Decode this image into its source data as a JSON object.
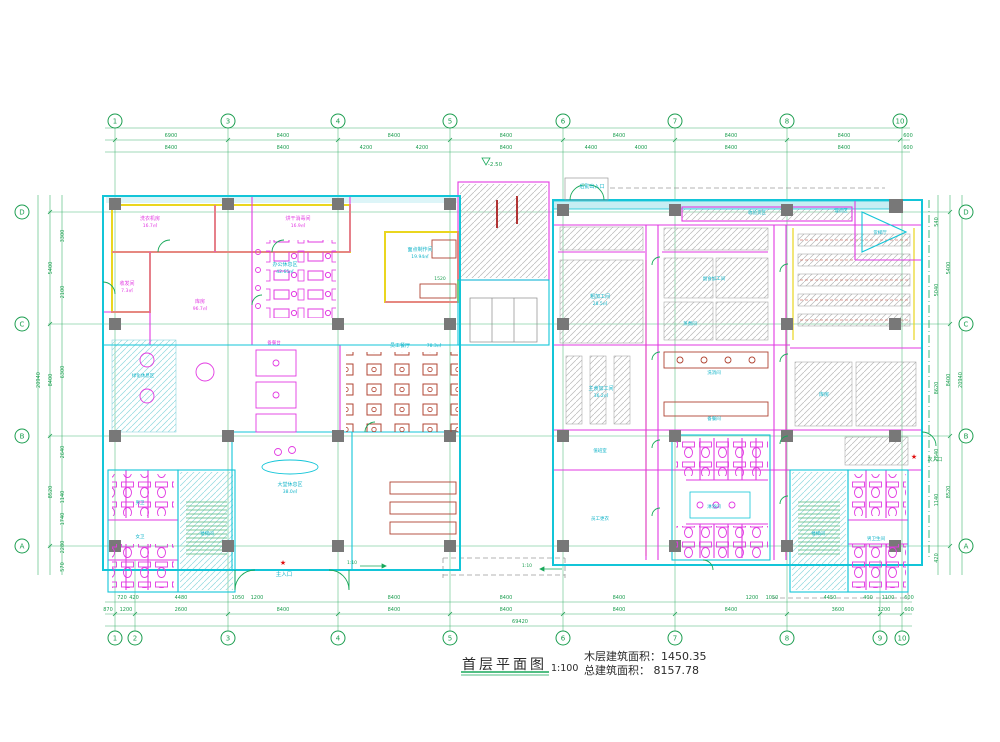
{
  "title_block": {
    "title": "首层平面图",
    "scale": "1:100",
    "area_line1": "木层建筑面积：1450.35",
    "area_line2": "总建筑面积： 8157.78"
  },
  "colors": {
    "grid_green": "#1c9e50",
    "wall_cyan": "#13c5d8",
    "wall_magenta": "#e23ae2",
    "wall_yellow": "#ead61f",
    "furniture_red": "#b04433",
    "entrance_red": "#e01010",
    "label_cyan": "#0fb3c8",
    "title_black": "#2a2a2a"
  },
  "grid": {
    "top_bubbles": [
      {
        "label": "1",
        "x": 115
      },
      {
        "label": "3",
        "x": 228
      },
      {
        "label": "4",
        "x": 338
      },
      {
        "label": "5",
        "x": 450
      },
      {
        "label": "6",
        "x": 563
      },
      {
        "label": "7",
        "x": 675
      },
      {
        "label": "8",
        "x": 787
      },
      {
        "label": "10",
        "x": 900
      }
    ],
    "bottom_bubbles": [
      {
        "label": "1",
        "x": 115
      },
      {
        "label": "2",
        "x": 135
      },
      {
        "label": "3",
        "x": 228
      },
      {
        "label": "4",
        "x": 338
      },
      {
        "label": "5",
        "x": 450
      },
      {
        "label": "6",
        "x": 563
      },
      {
        "label": "7",
        "x": 675
      },
      {
        "label": "8",
        "x": 787
      },
      {
        "label": "9",
        "x": 880
      },
      {
        "label": "10",
        "x": 902
      }
    ],
    "left_bubbles": [
      {
        "label": "D",
        "y": 212
      },
      {
        "label": "C",
        "y": 324
      },
      {
        "label": "B",
        "y": 436
      },
      {
        "label": "A",
        "y": 546
      }
    ],
    "right_bubbles": [
      {
        "label": "D",
        "y": 212
      },
      {
        "label": "C",
        "y": 324
      },
      {
        "label": "B",
        "y": 436
      },
      {
        "label": "A",
        "y": 546
      }
    ]
  },
  "dimensions": {
    "top_row1": [
      [
        "6900",
        171
      ],
      [
        "8400",
        283
      ],
      [
        "8400",
        394
      ],
      [
        "8400",
        506
      ],
      [
        "8400",
        619
      ],
      [
        "8400",
        731
      ],
      [
        "8400",
        844
      ],
      [
        "600",
        908
      ]
    ],
    "top_row2": [
      [
        "8400",
        171
      ],
      [
        "8400",
        283
      ],
      [
        "4200",
        366
      ],
      [
        "4200",
        422
      ],
      [
        "8400",
        506
      ],
      [
        "4400",
        591
      ],
      [
        "4000",
        641
      ],
      [
        "8400",
        731
      ],
      [
        "8400",
        844
      ],
      [
        "600",
        908
      ]
    ],
    "bottom_row1": [
      [
        "720",
        122
      ],
      [
        "420",
        134
      ],
      [
        "4480",
        181
      ],
      [
        "1050",
        238
      ],
      [
        "1200",
        257
      ],
      [
        "8400",
        394
      ],
      [
        "8400",
        506
      ],
      [
        "8400",
        619
      ],
      [
        "1200",
        752
      ],
      [
        "1050",
        772
      ],
      [
        "4450",
        830
      ],
      [
        "400",
        868
      ],
      [
        "1100",
        888
      ],
      [
        "600",
        909
      ]
    ],
    "bottom_row2": [
      [
        "870",
        108
      ],
      [
        "1200",
        126
      ],
      [
        "2600",
        181
      ],
      [
        "8400",
        283
      ],
      [
        "8400",
        394
      ],
      [
        "8400",
        506
      ],
      [
        "8400",
        619
      ],
      [
        "8400",
        731
      ],
      [
        "3600",
        838
      ],
      [
        "1200",
        884
      ],
      [
        "600",
        909
      ]
    ],
    "bottom_total": [
      [
        "69420",
        520
      ]
    ],
    "left": [
      [
        "20940",
        40,
        380
      ],
      [
        "5400",
        52,
        268
      ],
      [
        "8400",
        52,
        380
      ],
      [
        "8520",
        52,
        492
      ],
      [
        "3300",
        64,
        236
      ],
      [
        "2100",
        64,
        292
      ],
      [
        "6300",
        64,
        372
      ],
      [
        "2640",
        64,
        452
      ],
      [
        "1140",
        64,
        497
      ],
      [
        "1740",
        64,
        519
      ],
      [
        "2280",
        64,
        547
      ],
      [
        "570",
        64,
        567
      ]
    ],
    "right": [
      [
        "20940",
        962,
        380
      ],
      [
        "5400",
        950,
        268
      ],
      [
        "8400",
        950,
        380
      ],
      [
        "8520",
        950,
        492
      ],
      [
        "540",
        938,
        222
      ],
      [
        "5040",
        938,
        290
      ],
      [
        "8620",
        938,
        388
      ],
      [
        "2640",
        938,
        455
      ],
      [
        "1140",
        938,
        500
      ],
      [
        "420",
        938,
        558
      ]
    ]
  },
  "labels": [
    {
      "t": "洗衣机房",
      "x": 150,
      "y": 220,
      "c": "m",
      "s": 5
    },
    {
      "t": "16.7㎡",
      "x": 150,
      "y": 227,
      "c": "m",
      "s": 4.5
    },
    {
      "t": "烘干消毒间",
      "x": 298,
      "y": 220,
      "c": "m",
      "s": 5
    },
    {
      "t": "16.9㎡",
      "x": 298,
      "y": 227,
      "c": "m",
      "s": 4.5
    },
    {
      "t": "收发间",
      "x": 127,
      "y": 285,
      "c": "m",
      "s": 5
    },
    {
      "t": "7.3㎡",
      "x": 127,
      "y": 292,
      "c": "m",
      "s": 4.5
    },
    {
      "t": "库房",
      "x": 200,
      "y": 303,
      "c": "m",
      "s": 5
    },
    {
      "t": "96.7㎡",
      "x": 200,
      "y": 310,
      "c": "m",
      "s": 4.5
    },
    {
      "t": "办公休息区",
      "x": 285,
      "y": 266,
      "c": "c",
      "s": 5
    },
    {
      "t": "42.65㎡",
      "x": 285,
      "y": 273,
      "c": "c",
      "s": 4.5
    },
    {
      "t": "面点制作间",
      "x": 420,
      "y": 251,
      "c": "c",
      "s": 5
    },
    {
      "t": "19.94㎡",
      "x": 420,
      "y": 258,
      "c": "c",
      "s": 4.5
    },
    {
      "t": "员工餐厅",
      "x": 400,
      "y": 347,
      "c": "c",
      "s": 5
    },
    {
      "t": "78.3㎡",
      "x": 434,
      "y": 347,
      "c": "c",
      "s": 4.5
    },
    {
      "t": "备餐台",
      "x": 274,
      "y": 344,
      "c": "m",
      "s": 4.5
    },
    {
      "t": "绿化休息区",
      "x": 143,
      "y": 377,
      "c": "c",
      "s": 4.5
    },
    {
      "t": "大堂休息区",
      "x": 290,
      "y": 486,
      "c": "c",
      "s": 5
    },
    {
      "t": "38.0㎡",
      "x": 290,
      "y": 493,
      "c": "c",
      "s": 4.5
    },
    {
      "t": "主入口",
      "x": 284,
      "y": 576,
      "c": "c",
      "s": 5.5
    },
    {
      "t": "男卫",
      "x": 140,
      "y": 504,
      "c": "c",
      "s": 4.5
    },
    {
      "t": "女卫",
      "x": 140,
      "y": 538,
      "c": "c",
      "s": 4.5
    },
    {
      "t": "楼梯间",
      "x": 207,
      "y": 535,
      "c": "c",
      "s": 4.5
    },
    {
      "t": "后勤出入口",
      "x": 592,
      "y": 188,
      "c": "c",
      "s": 5
    },
    {
      "t": "收验货区",
      "x": 757,
      "y": 214,
      "c": "c",
      "s": 4.5
    },
    {
      "t": "理货区",
      "x": 841,
      "y": 212,
      "c": "c",
      "s": 4.5
    },
    {
      "t": "货梯厅",
      "x": 880,
      "y": 234,
      "c": "c",
      "s": 4.5
    },
    {
      "t": "粗加工间",
      "x": 600,
      "y": 298,
      "c": "c",
      "s": 5
    },
    {
      "t": "28.5㎡",
      "x": 600,
      "y": 305,
      "c": "c",
      "s": 4.5
    },
    {
      "t": "副食加工间",
      "x": 714,
      "y": 280,
      "c": "c",
      "s": 4.5
    },
    {
      "t": "蒸煮间",
      "x": 690,
      "y": 325,
      "c": "c",
      "s": 4.5
    },
    {
      "t": "主食加工间",
      "x": 601,
      "y": 390,
      "c": "c",
      "s": 5
    },
    {
      "t": "36.2㎡",
      "x": 601,
      "y": 397,
      "c": "c",
      "s": 4.5
    },
    {
      "t": "洗消间",
      "x": 714,
      "y": 374,
      "c": "c",
      "s": 4.5
    },
    {
      "t": "备餐间",
      "x": 714,
      "y": 420,
      "c": "c",
      "s": 4.5
    },
    {
      "t": "库房",
      "x": 824,
      "y": 396,
      "c": "c",
      "s": 5
    },
    {
      "t": "值班室",
      "x": 600,
      "y": 452,
      "c": "c",
      "s": 4.5
    },
    {
      "t": "员工更衣",
      "x": 600,
      "y": 520,
      "c": "c",
      "s": 4.5
    },
    {
      "t": "淋浴间",
      "x": 714,
      "y": 508,
      "c": "c",
      "s": 4.5
    },
    {
      "t": "男卫生间",
      "x": 876,
      "y": 540,
      "c": "c",
      "s": 4.5
    },
    {
      "t": "楼梯间",
      "x": 818,
      "y": 535,
      "c": "c",
      "s": 4.5
    },
    {
      "t": "次入口",
      "x": 935,
      "y": 461,
      "c": "g",
      "s": 5
    },
    {
      "t": "1:10",
      "x": 352,
      "y": 564,
      "c": "g",
      "s": 4.5
    },
    {
      "t": "1:10",
      "x": 527,
      "y": 567,
      "c": "g",
      "s": 4.5
    },
    {
      "t": "-2.50",
      "x": 495,
      "y": 166,
      "c": "g",
      "s": 5.5
    },
    {
      "t": "1520",
      "x": 440,
      "y": 280,
      "c": "g",
      "s": 4.5
    }
  ],
  "markers": {
    "main_entrance_star": {
      "x": 283,
      "y": 565,
      "glyph": "★"
    },
    "secondary_entrance_star": {
      "x": 914,
      "y": 459,
      "glyph": "★"
    }
  }
}
